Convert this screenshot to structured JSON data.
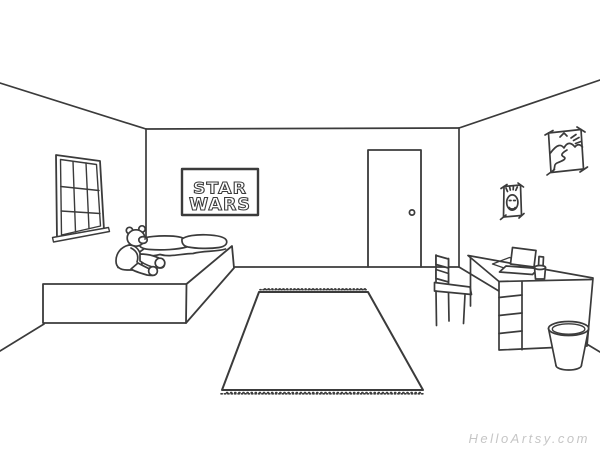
{
  "poster": {
    "line1": "STAR",
    "line2": "WARS"
  },
  "watermark": {
    "text": "HelloArtsy.com"
  },
  "colors": {
    "ink": "#3b3b3b",
    "background": "#ffffff",
    "watermark": "#c6c6c6"
  },
  "scene": {
    "description_objects": [
      "bedroom-one-point-perspective",
      "window",
      "window-sill",
      "bed",
      "pillows",
      "blanket",
      "teddy-bear",
      "star-wars-poster",
      "door",
      "door-knob",
      "landscape-picture",
      "portrait-picture",
      "rug",
      "rug-fringe",
      "chair",
      "desk",
      "desk-drawers",
      "laptop",
      "desk-pad",
      "pencil-cup",
      "trash-can"
    ]
  }
}
